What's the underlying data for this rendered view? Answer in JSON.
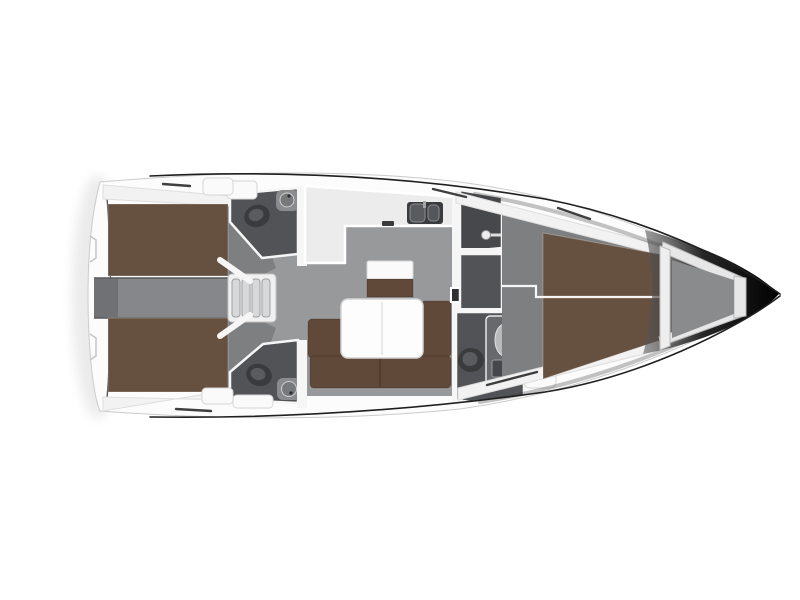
{
  "canvas": {
    "width": 800,
    "height": 600,
    "background": "#ffffff"
  },
  "diagram": {
    "kind": "sailing-yacht-interior-floor-plan-top-view",
    "orientation": {
      "bow": "right",
      "stern": "left"
    },
    "features": [
      "hull-outline",
      "transom",
      "aft-cabin-port-berth",
      "aft-cabin-starboard-berth",
      "aft-corridor",
      "companionway-steps",
      "aft-head-port",
      "aft-head-starboard",
      "toilet",
      "washbasin",
      "salon-floor",
      "galley-counter",
      "galley-sink",
      "stove",
      "nav-bench",
      "salon-table",
      "salon-sofa",
      "forward-head",
      "shower-cabin",
      "wardrobe-hangers",
      "forward-cabin-v-berth",
      "anchor-locker",
      "bow-tip",
      "deck-hatch",
      "sheer-line"
    ]
  },
  "colors": {
    "hull_fill": "#fcfcfc",
    "hull_stroke": "#cbcbcb",
    "sheer_line": "#1f1f1f",
    "wall_white": "#f6f6f7",
    "floor_gray": "#98999b",
    "cabin_floor_gray": "#7e7f81",
    "corridor_gray": "#86878a",
    "dark_room": "#525356",
    "darker_room": "#47484b",
    "berth_brown": "#66503f",
    "sofa_brown": "#61493a",
    "table_white": "#fdfdfd",
    "counter_light": "#ececed",
    "fixture_dark": "#3a3b3d",
    "fixture_light": "#8a8b8d",
    "silver": "#e7e7e8",
    "bow_dark": "#0d0d0d"
  }
}
